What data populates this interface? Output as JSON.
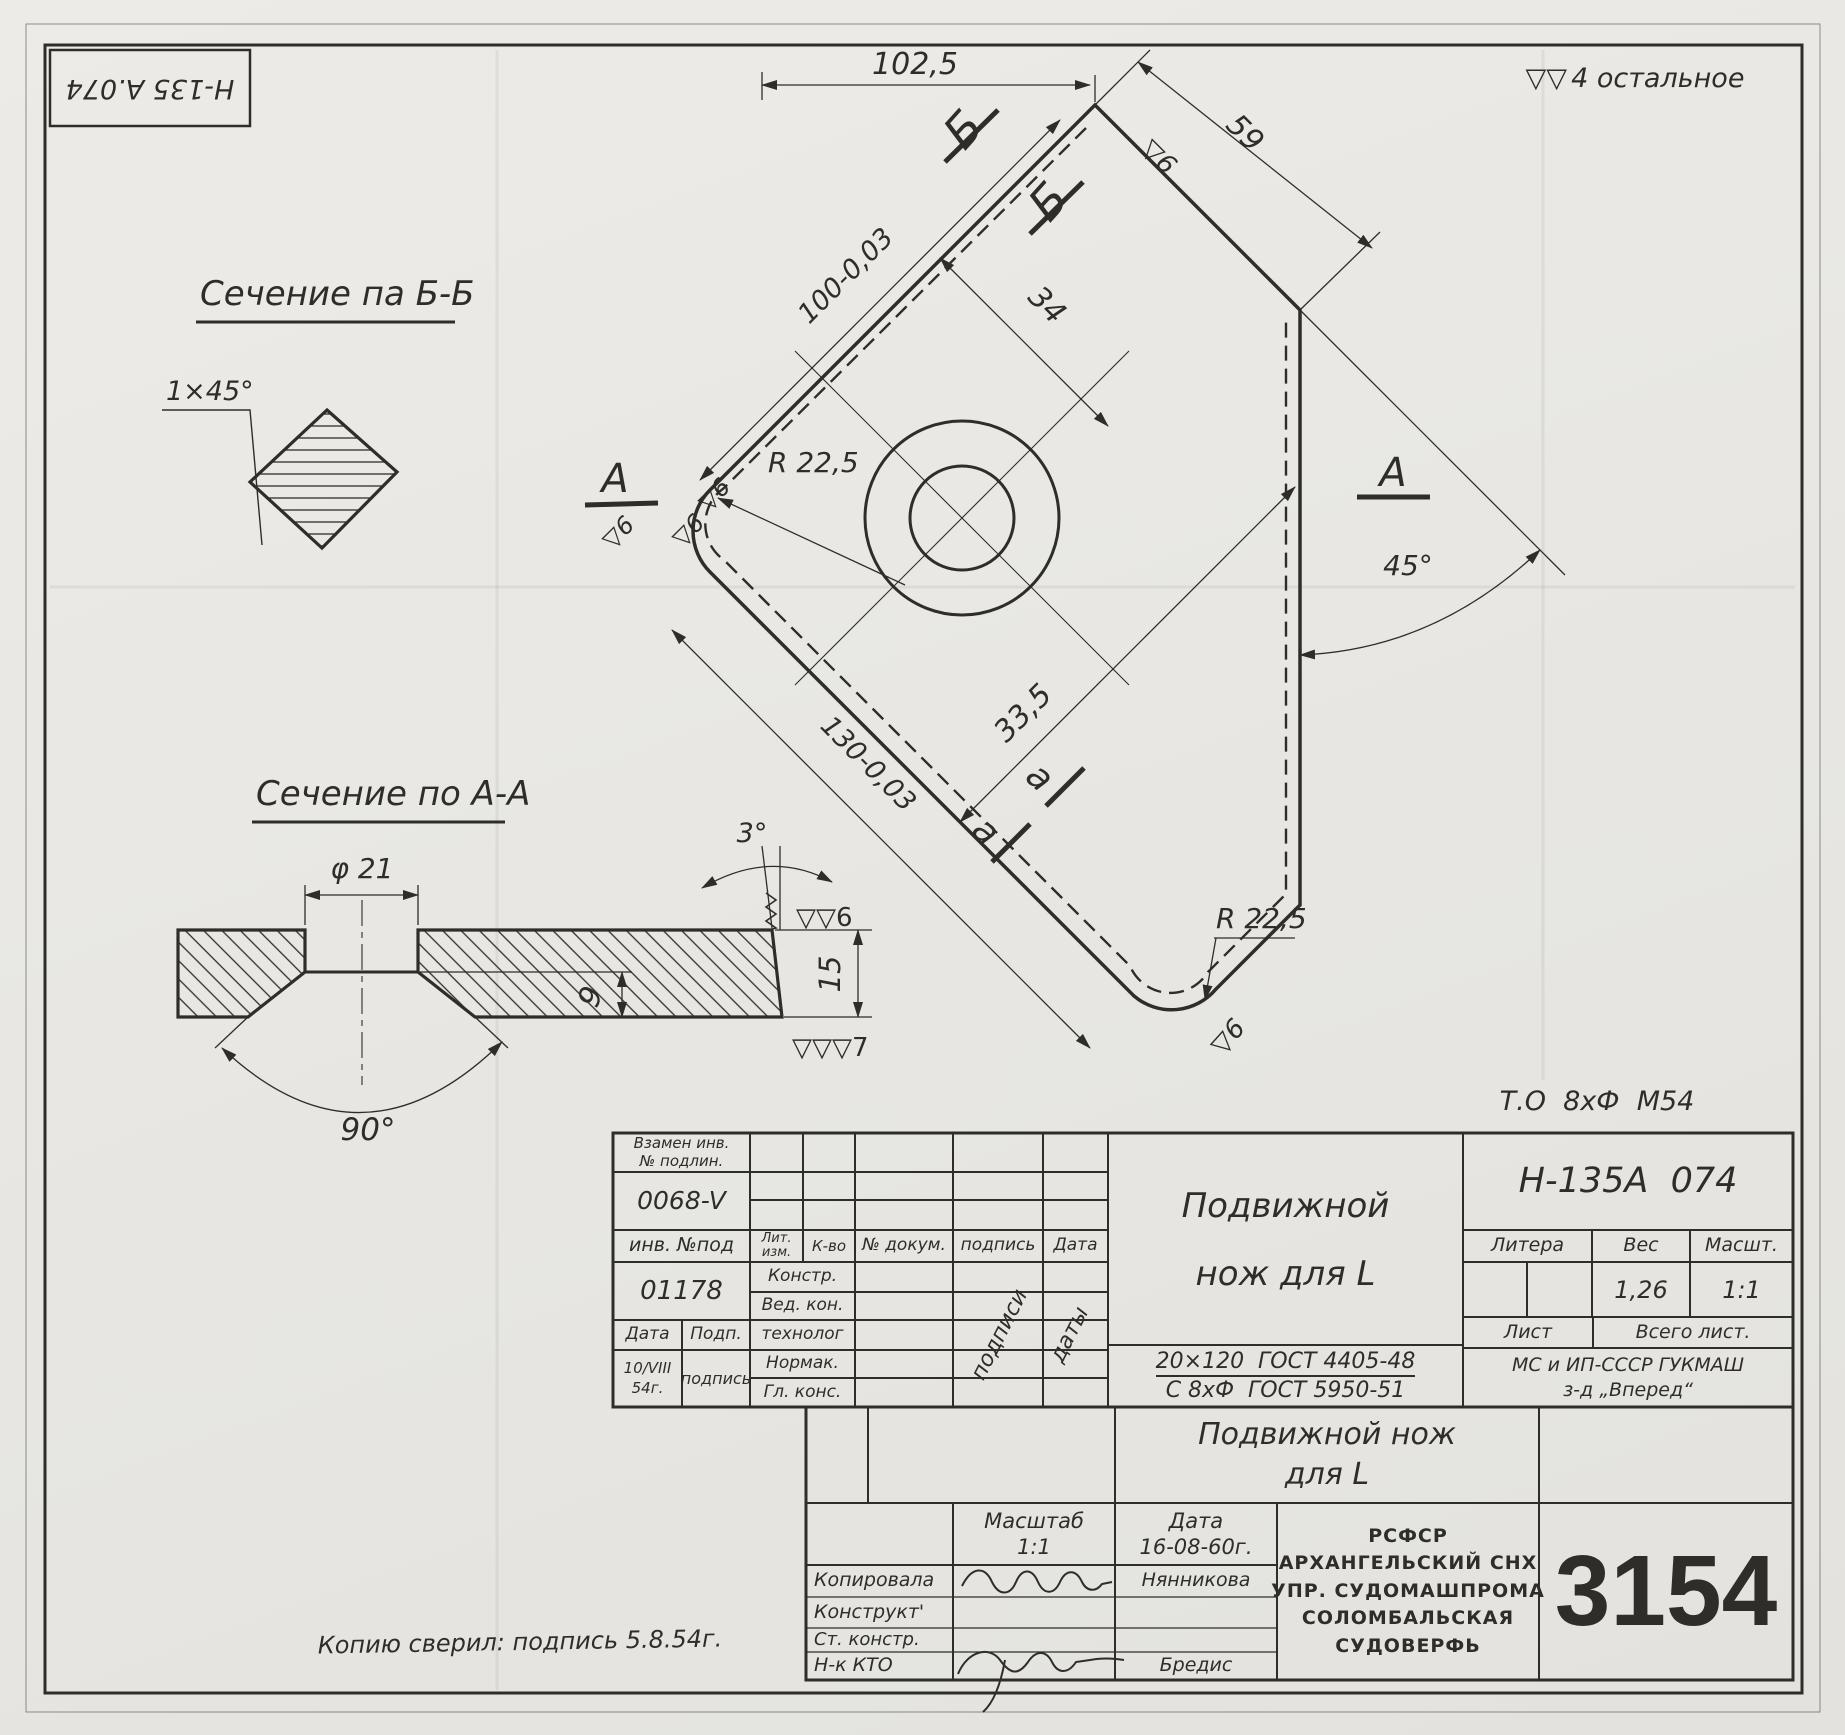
{
  "sheet": {
    "corner_code": "Н-135 А.074",
    "finish_marks": "▽▽",
    "finish_note": "4 остальное",
    "to_note": "Т.О  8хФ  М54",
    "copy_note": "Копию сверил: подпись 5.8.54г.",
    "order_number": "3154"
  },
  "main_view": {
    "dim_102_5": "102,5",
    "dim_59": "59",
    "dim_100": "100-0,03",
    "dim_34": "34",
    "dim_33_5": "33,5",
    "dim_130": "130-0,03",
    "radius_left": "R 22,5",
    "radius_bottom": "R 22,5",
    "angle_45": "45°",
    "section_b": "Б",
    "section_a": "А",
    "section_a_small": "а",
    "finish_6": "▽6"
  },
  "section_bb": {
    "title": "Сечение па Б-Б",
    "chamfer": "1×45°"
  },
  "section_aa": {
    "title": "Сечение  по А-А",
    "diameter": "φ 21",
    "edge_angle": "3°",
    "countersink_angle": "90°",
    "depth": "9",
    "thickness": "15",
    "finish_top": "▽▽6",
    "finish_bottom": "▽▽▽7"
  },
  "title_block": {
    "replaced_inv_label1": "Взамен инв.",
    "replaced_inv_label2": "№ подлин.",
    "replaced_inv_value": "0068-V",
    "inv_label": "инв. №под",
    "inv_value": "01178",
    "col_lit1": "Лит.",
    "col_lit2": "изм.",
    "col_qty": "К-во",
    "col_doc": "№ докум.",
    "col_sign": "подпись",
    "col_date": "Дата",
    "roles": [
      "Констр.",
      "Вед. кон.",
      "технолог",
      "Нормак.",
      "Гл. конс."
    ],
    "date_label": "Дата",
    "podp_label": "Подп.",
    "date_value1": "10/VIII",
    "date_value2": "54г.",
    "podp_value": "подпись",
    "diag_signs": "подписи",
    "diag_dates": "даты",
    "part_title1": "Подвижной",
    "part_title2": "нож для L",
    "doc_number": "Н-135А  074",
    "litera_label": "Литера",
    "weight_label": "Вес",
    "scale_label": "Масшт.",
    "weight_value": "1,26",
    "scale_value": "1:1",
    "sheet_label": "Лист",
    "total_sheets_label": "Всего лист.",
    "org_line1": "МС и ИП-СССР ГУКМАШ",
    "org_line2": "з-д „Вперед“",
    "material_line1": "20×120  ГОСТ 4405-48",
    "material_line2": "С 8хФ  ГОСТ 5950-51",
    "title2_line1": "Подвижной нож",
    "title2_line2": "для L",
    "scale2_label": "Масштаб",
    "scale2_value": "1:1",
    "date2_label": "Дата",
    "date2_value": "16-08-60г.",
    "row_copied": "Копировала",
    "copied_name": "Нянникова",
    "row_designer": "Конструкт'",
    "row_senior": "Ст. констр.",
    "row_nk": "Н-к КТО",
    "nk_name": "Бредис",
    "factory_lines": [
      "РСФСР",
      "АРХАНГЕЛЬСКИЙ СНХ",
      "УПР. СУДОМАШПРОМА",
      "СОЛОМБАЛЬСКАЯ",
      "СУДОВЕРФЬ"
    ]
  }
}
